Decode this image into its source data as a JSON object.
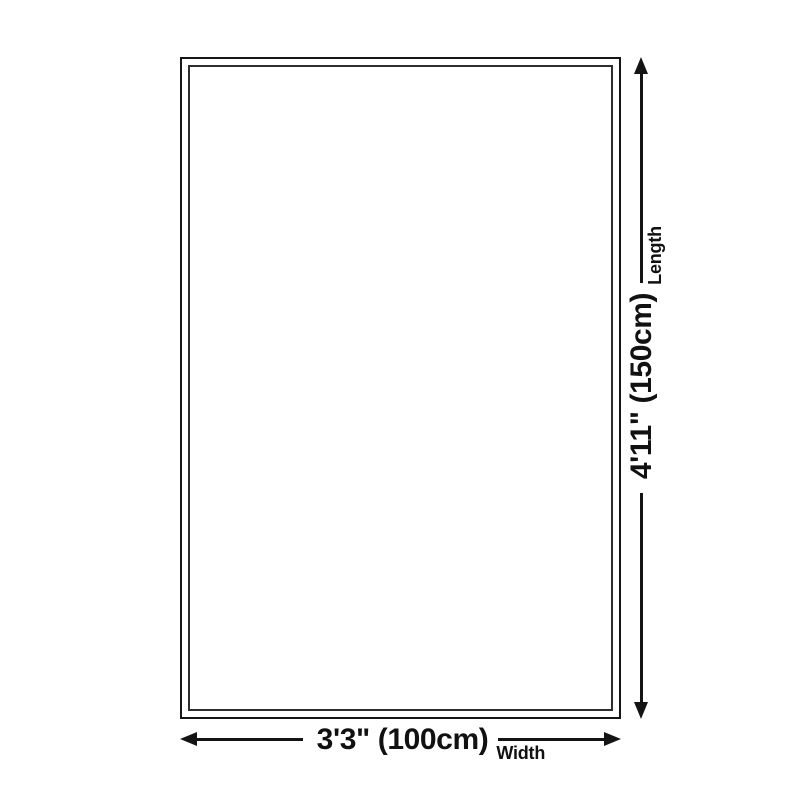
{
  "diagram": {
    "dimensions": {
      "length": {
        "value": "4'11\" (150cm)",
        "label": "Length"
      },
      "width": {
        "value": "3'3\" (100cm)",
        "label": "Width"
      }
    },
    "colors": {
      "background": "#ffffff",
      "outer_border": "#161616",
      "inner_border": "#2e2e2e",
      "arrow_line": "#141414",
      "text": "#111111"
    }
  }
}
